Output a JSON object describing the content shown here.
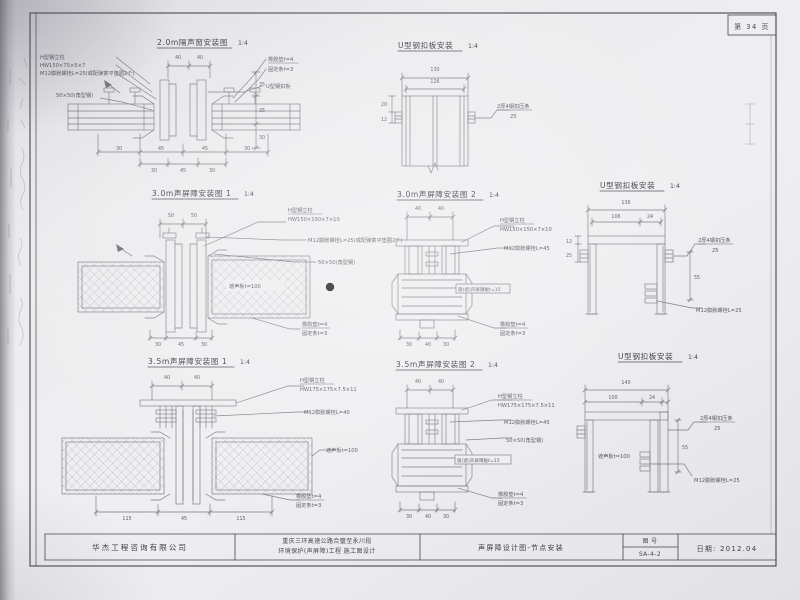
{
  "page": {
    "page_number": "第 34 页"
  },
  "titleblock": {
    "company": "华杰工程咨询有限公司",
    "project_line1": "重庆三环高速公路合璧至永川段",
    "project_line2": "环境保护(声屏障)工程  施工图设计",
    "sheet_title": "声屏障设计图-节点安装",
    "drawing_no_label": "图  号",
    "drawing_no": "SA-4-2",
    "date": "日期: 2012.04"
  },
  "titles": {
    "d1": {
      "name": "2.0m隔声窗安装图",
      "scale": "1:4"
    },
    "d2": {
      "name": "U型钢扣板安装",
      "scale": "1:4"
    },
    "d3": {
      "name": "3.0m声屏障安装图 1",
      "scale": "1:4"
    },
    "d4": {
      "name": "3.0m声屏障安装图 2",
      "scale": "1:4"
    },
    "d5": {
      "name": "U型钢扣板安装",
      "scale": "1:4"
    },
    "d6": {
      "name": "3.5m声屏障安装图 1",
      "scale": "1:4"
    },
    "d7": {
      "name": "3.5m声屏障安装图 2",
      "scale": "1:4"
    },
    "d8": {
      "name": "U型钢扣板安装",
      "scale": "1:4"
    }
  },
  "ann": {
    "h_column": "H型钢立柱",
    "spec_150_75": "HW150×75×5×7",
    "spec_150": "HW150×150×7×10",
    "spec_175": "HW175×175×7.5×11",
    "bolt25_full": "M12膨胀螺栓L=25(或配弹簧平垫圈2个)",
    "bolt25": "M12膨胀螺栓L=25",
    "bolt40": "M12膨胀螺栓L=40",
    "bolt45": "M12膨胀螺栓L=45",
    "angle": "50×50(角型钢)",
    "rubber": "橡胶垫t=4",
    "fixer": "固定条t=3",
    "u_plate": "U型钢扣板",
    "clamp_strip": "2厚4钢扣压条",
    "clamp_len": "25",
    "shield": "遮声板t=100",
    "absorb": "吸(遮)声屏障板t=15"
  },
  "dims": {
    "d12": "12",
    "d20": "20",
    "d24": "24",
    "d25": "25",
    "d30": "30",
    "d35": "35",
    "d40": "40",
    "d45": "45",
    "d50": "50",
    "d55": "55",
    "d100": "100",
    "d106": "106",
    "d115": "115",
    "d126": "126",
    "d130": "130",
    "d136": "136",
    "d140": "140"
  }
}
